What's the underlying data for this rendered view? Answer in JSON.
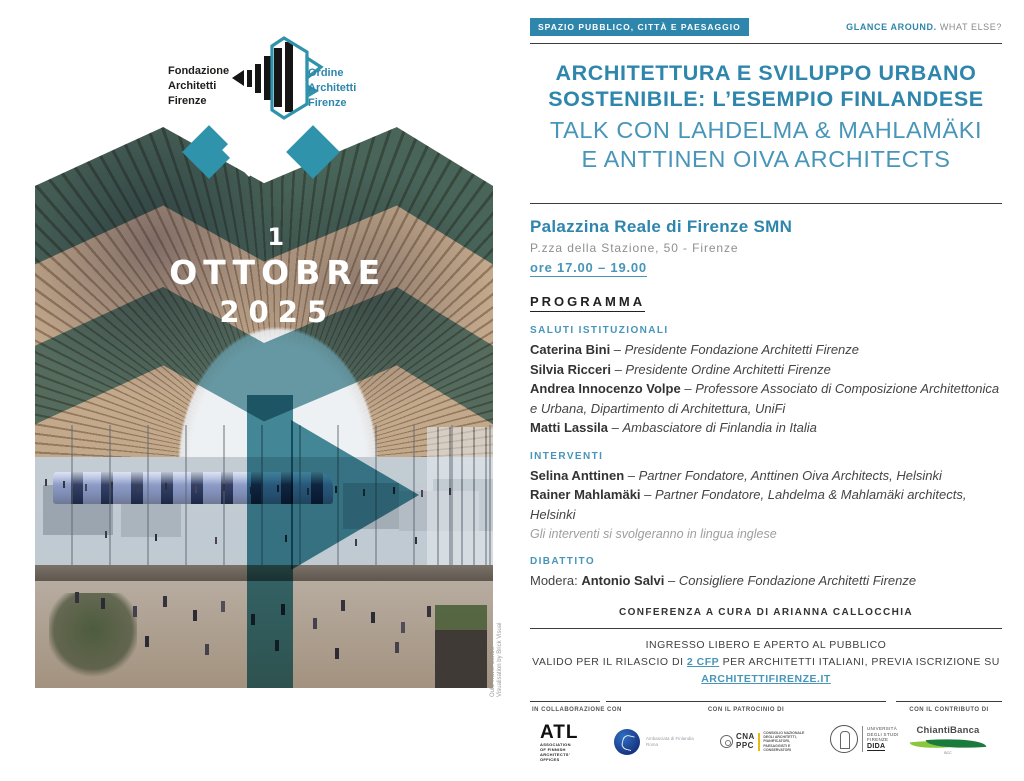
{
  "colors": {
    "accent": "#2e86ac",
    "accent_light": "#4795b8",
    "image_teal": "#0c6273",
    "badge_text": "#ffffff"
  },
  "masthead": {
    "badge": "SPAZIO PUBBLICO, CITTÀ E PAESAGGIO",
    "brand_strong": "GLANCE AROUND.",
    "brand_light": "WHAT ELSE?"
  },
  "org_header": {
    "left": {
      "line1": "Fondazione",
      "line2": "Architetti",
      "line3": "Firenze"
    },
    "right": {
      "line1": "Ordine",
      "line2": "Architetti",
      "line3": "Firenze"
    },
    "logo": "fondazione-ordine-architetti-firenze-mark"
  },
  "poster": {
    "date_line1": "1",
    "date_line2": "OTTOBRE",
    "date_line3": "2025",
    "caption_line1": "Oulu Travel Centre",
    "caption_line2": "Visualisation by Brick Visual"
  },
  "title": {
    "line1": "ARCHITETTURA E SVILUPPO URBANO",
    "line2": "SOSTENIBILE: L’ESEMPIO FINLANDESE",
    "sub1": "TALK CON LAHDELMA & MAHLAMÄKI",
    "sub2": "E ANTTINEN OIVA ARCHITECTS"
  },
  "venue": {
    "name": "Palazzina Reale di Firenze SMN",
    "address": "P.zza della Stazione, 50 - Firenze",
    "time": "ore 17.00 – 19.00"
  },
  "program": {
    "heading": "PROGRAMMA",
    "separator": " – ",
    "sections": [
      {
        "id": "saluti",
        "title": "SALUTI ISTITUZIONALI",
        "items": [
          {
            "name": "Caterina Bini",
            "role": "Presidente Fondazione Architetti Firenze"
          },
          {
            "name": "Silvia Ricceri",
            "role": "Presidente Ordine Architetti Firenze"
          },
          {
            "name": "Andrea Innocenzo Volpe",
            "role": "Professore Associato di Composizione Architettonica e Urbana, Dipartimento di Architettura, UniFi"
          },
          {
            "name": "Matti Lassila",
            "role": "Ambasciatore di Finlandia in Italia"
          }
        ]
      },
      {
        "id": "interventi",
        "title": "INTERVENTI",
        "items": [
          {
            "name": "Selina Anttinen",
            "role": "Partner Fondatore, Anttinen Oiva Architects, Helsinki"
          },
          {
            "name": "Rainer Mahlamäki",
            "role": "Partner Fondatore, Lahdelma & Mahlamäki architects, Helsinki"
          }
        ],
        "note": "Gli interventi si svolgeranno in lingua inglese"
      },
      {
        "id": "dibattito",
        "title": "DIBATTITO",
        "items": [
          {
            "prefix": "Modera: ",
            "name": "Antonio Salvi",
            "role": "Consigliere Fondazione Architetti Firenze"
          }
        ]
      }
    ]
  },
  "curator": "CONFERENZA A CURA DI ARIANNA CALLOCCHIA",
  "footer": {
    "line1": "INGRESSO LIBERO E APERTO AL PUBBLICO",
    "line2_part1": "VALIDO PER IL RILASCIO DI ",
    "line2_link1": "2 CFP",
    "line2_part2": " PER ARCHITETTI ITALIANI, PREVIA ISCRIZIONE SU ",
    "line2_link2": "ARCHITETTIFIRENZE.IT"
  },
  "partners": [
    {
      "label": "IN COLLABORAZIONE CON"
    },
    {
      "label": "CON IL PATROCINIO DI"
    },
    {
      "label": "CON IL CONTRIBUTO DI"
    }
  ],
  "partner_logos": {
    "atl": {
      "big": "ATL",
      "small1": "ASSOCIATION",
      "small2": "OF FINNISH",
      "small3": "ARCHITECTS’",
      "small4": "OFFICES"
    },
    "embassy": {
      "line1": "Ambasciata di Finlandia",
      "line2": "Roma"
    },
    "cnappc": {
      "letters1": "CNA",
      "letters2": "PPC",
      "small1": "CONSIGLIO NAZIONALE",
      "small2": "DEGLI ARCHITETTI,",
      "small3": "PIANIFICATORI,",
      "small4": "PAESAGGISTI E",
      "small5": "CONSERVATORI"
    },
    "unifi": {
      "line1": "UNIVERSITÀ",
      "line2": "DEGLI STUDI",
      "line3": "FIRENZE",
      "dept": "DIDA"
    },
    "chianti": {
      "name": "ChiantiBanca",
      "sub": "BCC"
    }
  }
}
